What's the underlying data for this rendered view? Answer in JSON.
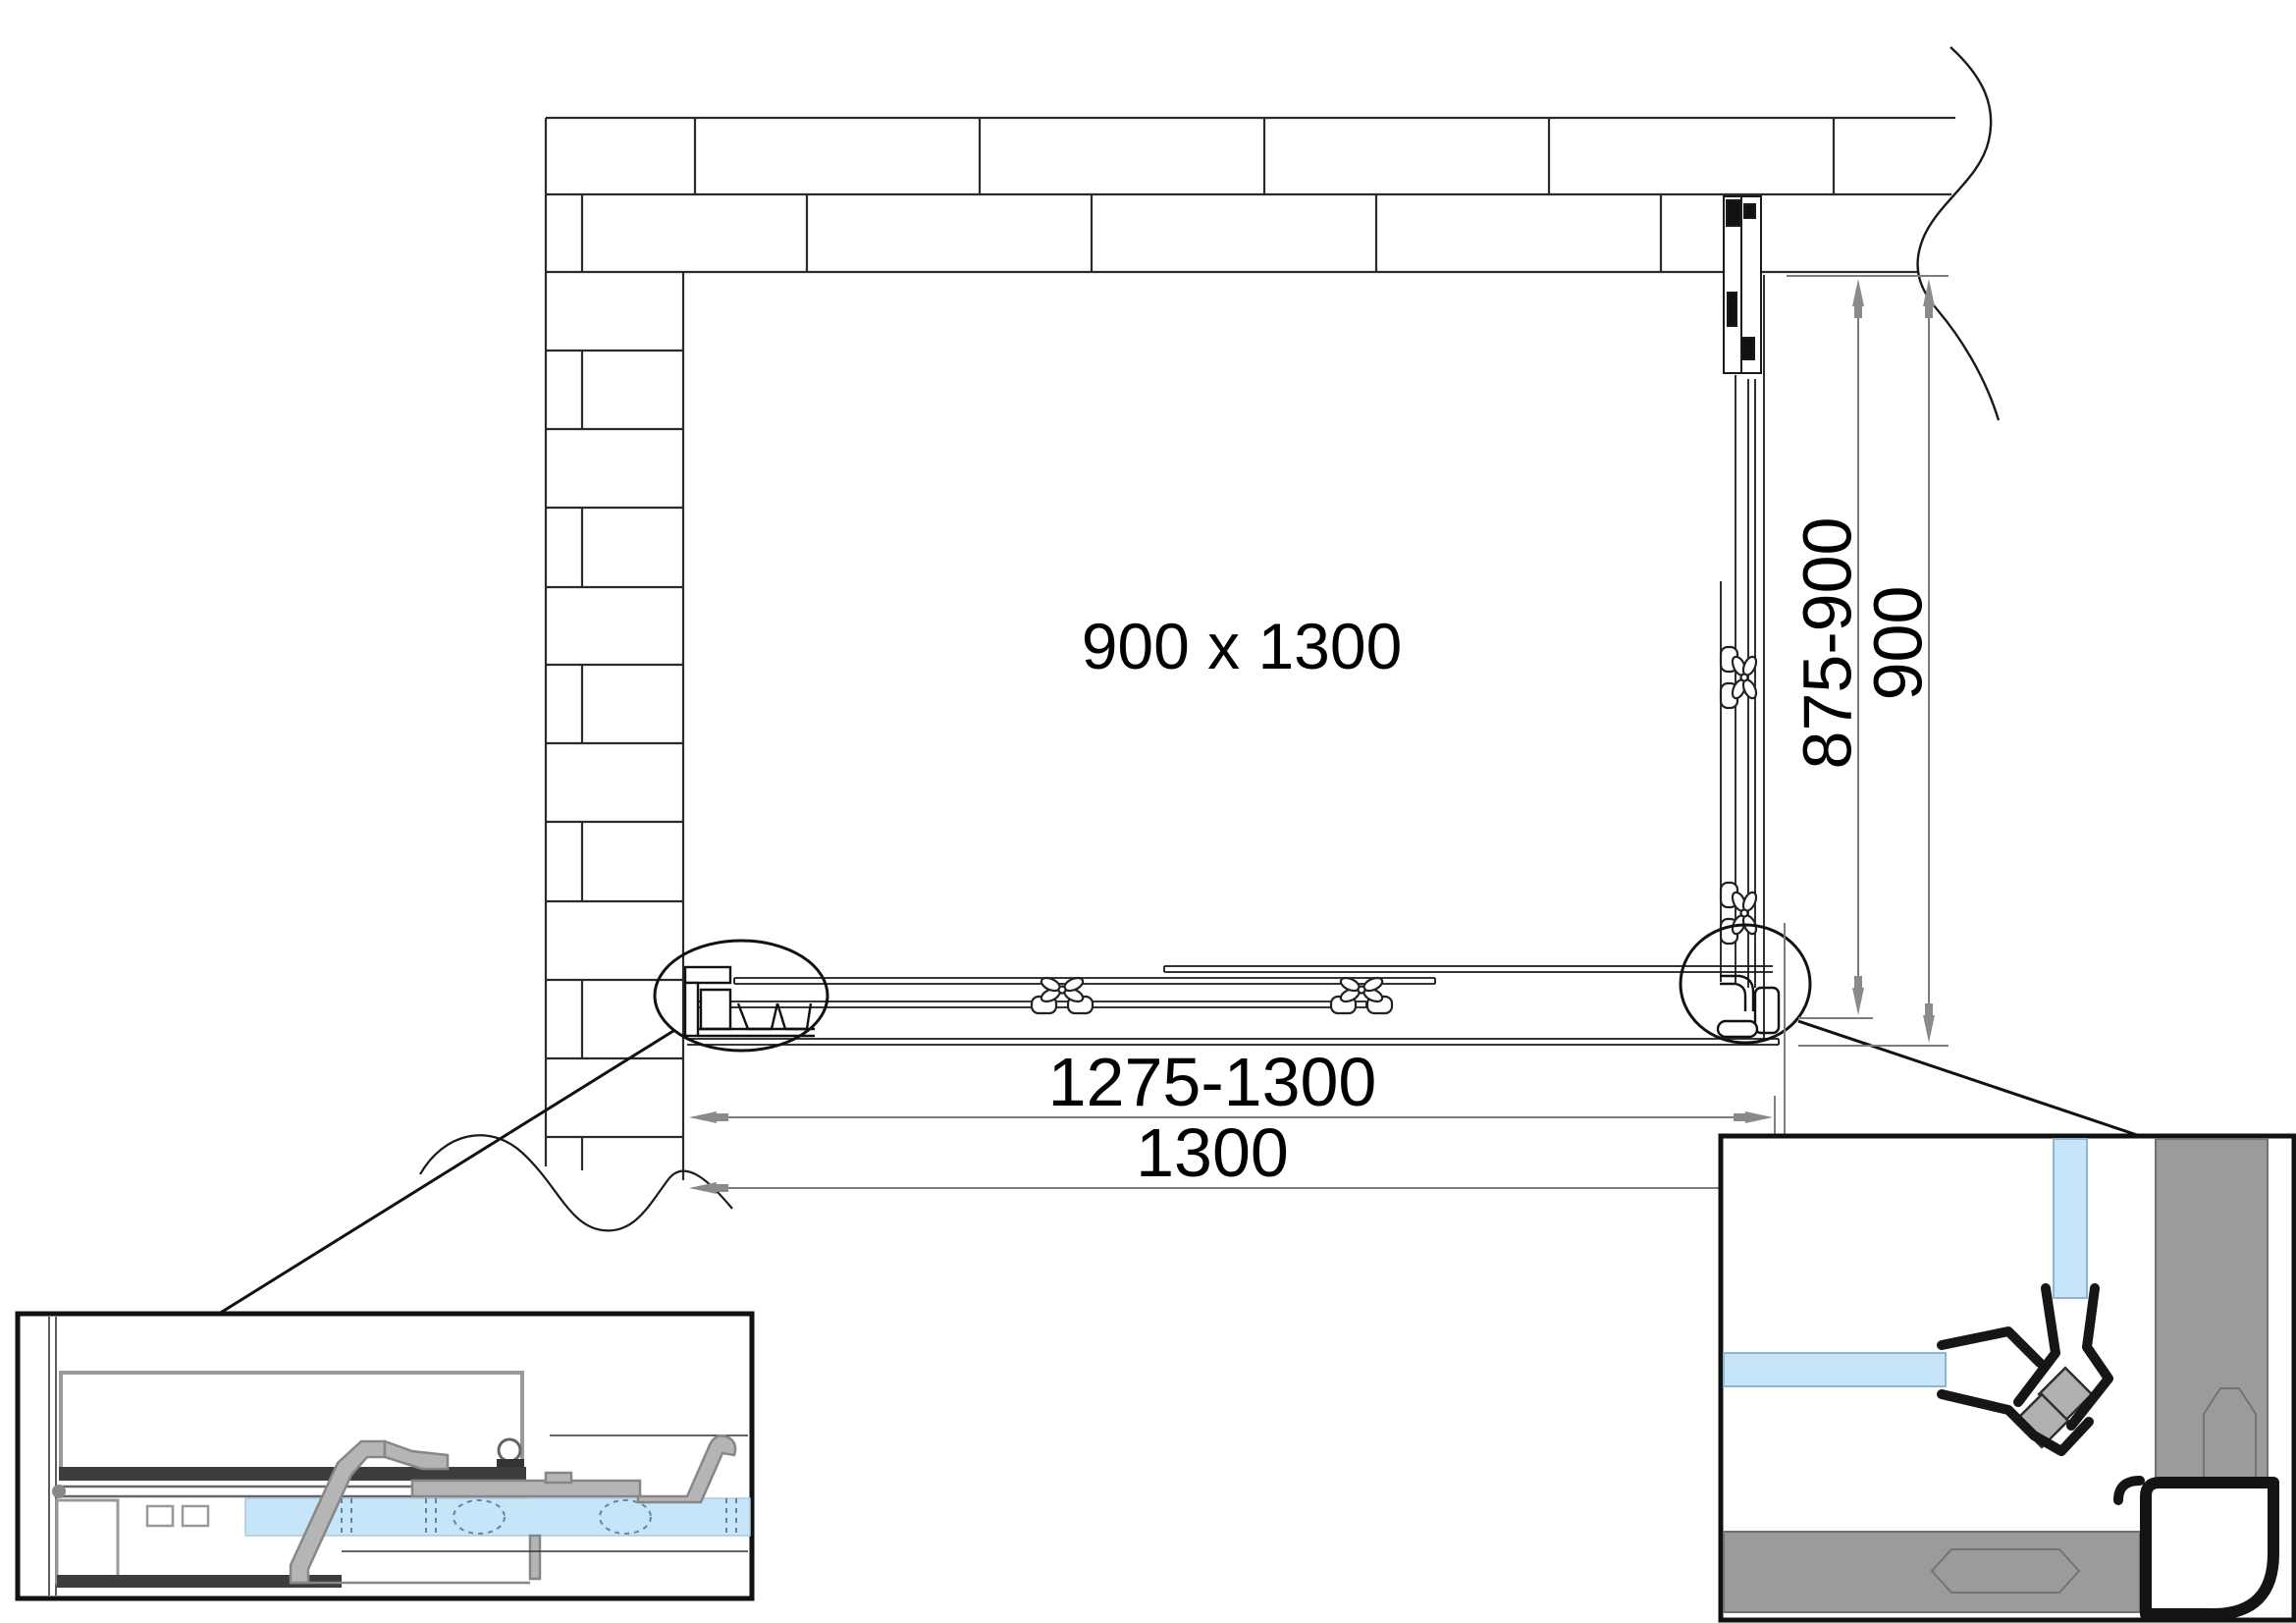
{
  "drawing": {
    "product_label": "900 x 1300",
    "dimensions": {
      "width_adjustable": "1275-1300",
      "width_nominal": "1300",
      "depth_adjustable": "875-900",
      "depth_nominal": "900"
    },
    "colors": {
      "glass_fill": "#C6E5F8",
      "glass_edge": "#8FB6CE",
      "profile_gray": "#9B9B9B",
      "profile_light_gray": "#B5B5B5",
      "dark_bar": "#3D3D3D",
      "seal_black": "#161616",
      "dim_line_gray": "#7D7D7D",
      "outline": "#1A1A1A"
    }
  }
}
